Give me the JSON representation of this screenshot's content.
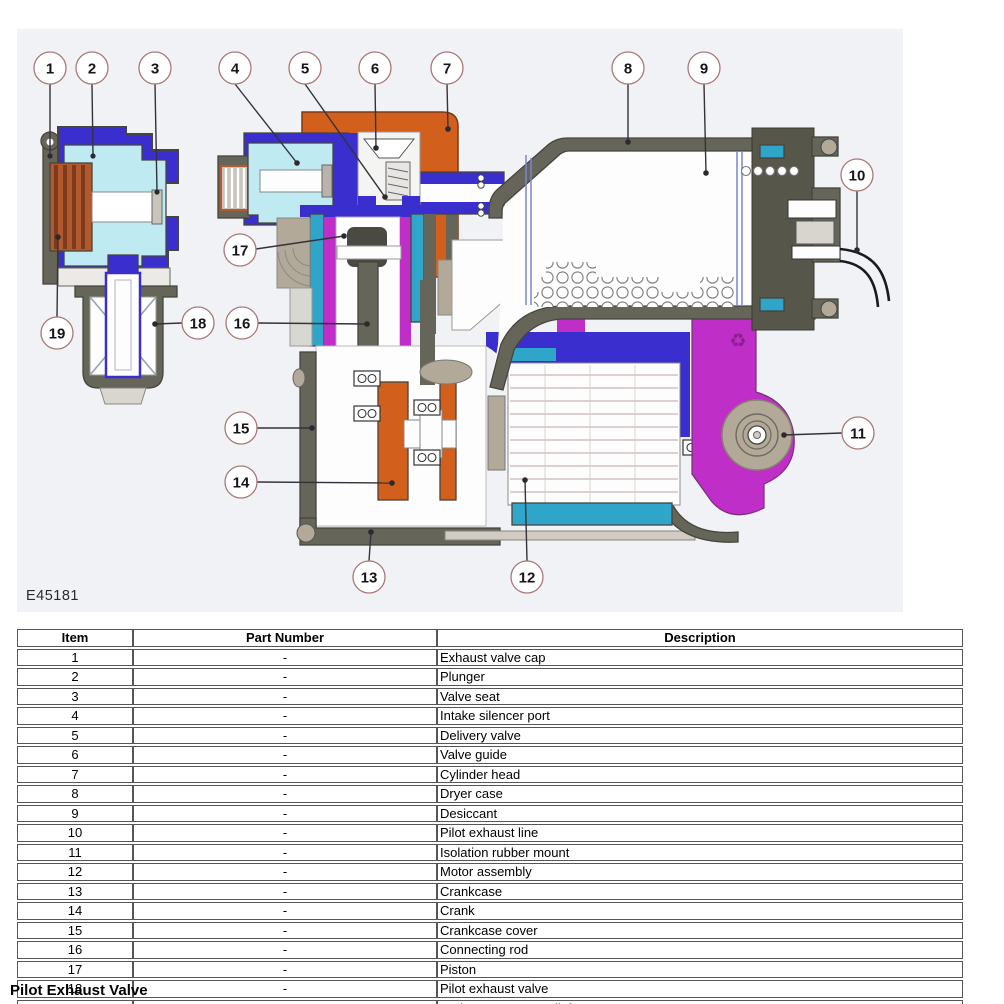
{
  "diagram": {
    "figure_code": "E45181",
    "callouts": [
      "1",
      "2",
      "3",
      "4",
      "5",
      "6",
      "7",
      "8",
      "9",
      "10",
      "11",
      "12",
      "13",
      "14",
      "15",
      "16",
      "17",
      "18",
      "19"
    ],
    "recycle_glyph": "♻",
    "colors": {
      "background": "#f1f2f5",
      "housing_blue": "#3a2ecf",
      "cyan": "#bfeaf2",
      "teal": "#2fa6c9",
      "orange": "#d35f1d",
      "spring_rust": "#b25a2d",
      "magenta": "#bf2ec6",
      "case_olive": "#65655a",
      "mount_tan": "#b3a998"
    }
  },
  "table": {
    "headers": [
      "Item",
      "Part Number",
      "Description"
    ],
    "rows": [
      {
        "item": "1",
        "part": "-",
        "desc": "Exhaust valve cap"
      },
      {
        "item": "2",
        "part": "-",
        "desc": "Plunger"
      },
      {
        "item": "3",
        "part": "-",
        "desc": "Valve seat"
      },
      {
        "item": "4",
        "part": "-",
        "desc": "Intake silencer port"
      },
      {
        "item": "5",
        "part": "-",
        "desc": "Delivery valve"
      },
      {
        "item": "6",
        "part": "-",
        "desc": "Valve guide"
      },
      {
        "item": "7",
        "part": "-",
        "desc": "Cylinder head"
      },
      {
        "item": "8",
        "part": "-",
        "desc": "Dryer case"
      },
      {
        "item": "9",
        "part": "-",
        "desc": "Desiccant"
      },
      {
        "item": "10",
        "part": "-",
        "desc": "Pilot exhaust line"
      },
      {
        "item": "11",
        "part": "-",
        "desc": "Isolation rubber mount"
      },
      {
        "item": "12",
        "part": "-",
        "desc": "Motor assembly"
      },
      {
        "item": "13",
        "part": "-",
        "desc": "Crankcase"
      },
      {
        "item": "14",
        "part": "-",
        "desc": "Crank"
      },
      {
        "item": "15",
        "part": "-",
        "desc": "Crankcase cover"
      },
      {
        "item": "16",
        "part": "-",
        "desc": "Connecting rod"
      },
      {
        "item": "17",
        "part": "-",
        "desc": "Piston"
      },
      {
        "item": "18",
        "part": "-",
        "desc": "Pilot exhaust valve"
      },
      {
        "item": "19",
        "part": "-",
        "desc": "Spring - pressure relief"
      }
    ]
  },
  "footer": {
    "title": "Pilot Exhaust Valve"
  }
}
